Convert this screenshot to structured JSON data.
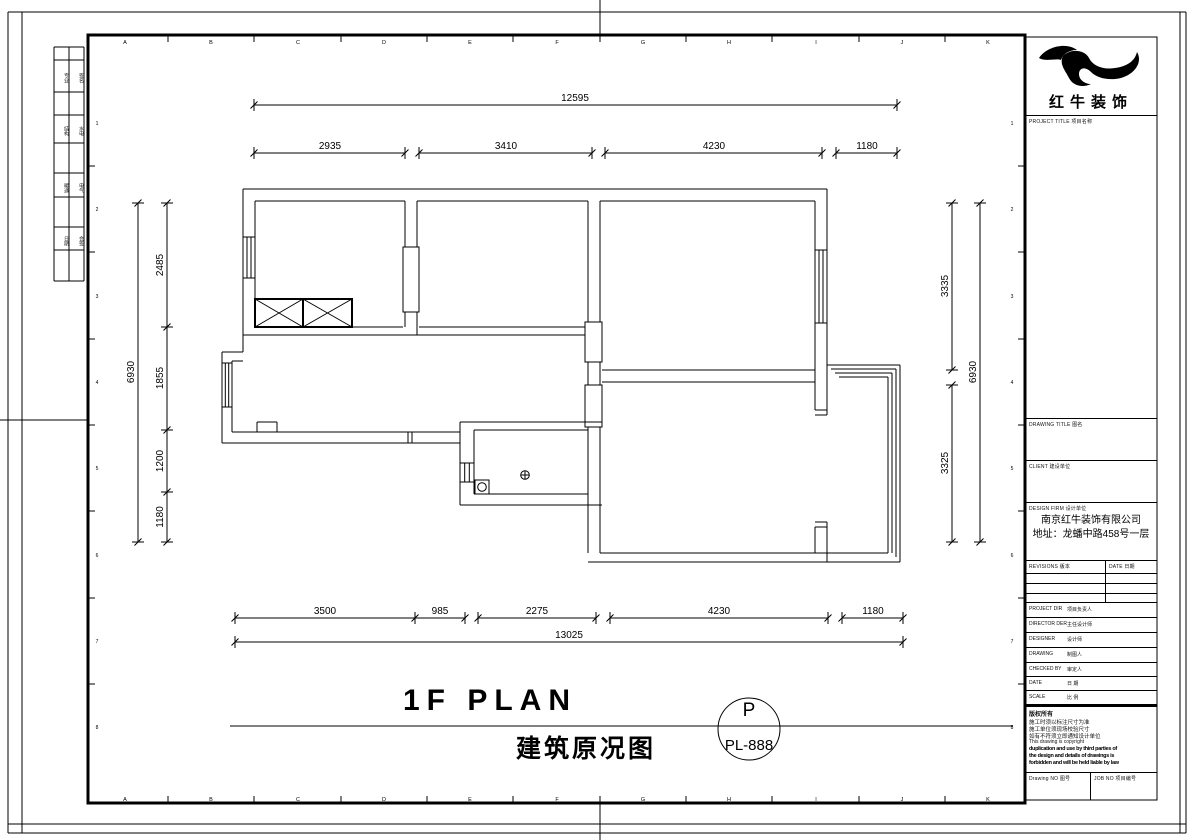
{
  "sheet": {
    "ruler_letters": [
      "A",
      "B",
      "C",
      "D",
      "E",
      "F",
      "G",
      "H",
      "I",
      "J",
      "K"
    ],
    "ruler_numbers": [
      "1",
      "2",
      "3",
      "4",
      "5",
      "6",
      "7",
      "8"
    ],
    "margin_cells": [
      "专业",
      "签名",
      "结构",
      "水电",
      "暖通",
      "电气",
      "日期",
      "会签"
    ]
  },
  "plan": {
    "dim_top_overall": "12595",
    "dim_top": [
      "2935",
      "3410",
      "4230",
      "1180"
    ],
    "dim_left_overall": "6930",
    "dim_left": [
      "2485",
      "1855",
      "1200",
      "1180"
    ],
    "dim_right_overall": "6930",
    "dim_right": [
      "3335",
      "3325"
    ],
    "dim_bottom": [
      "3500",
      "985",
      "2275",
      "4230",
      "1180"
    ],
    "dim_bottom_overall": "13025"
  },
  "title": {
    "main": "1F PLAN",
    "subtitle": "建筑原况图",
    "badge_letter": "P",
    "badge_code": "PL-888"
  },
  "titleblock": {
    "brand": "红牛装饰",
    "labels": {
      "project_title": "PROJECT TITLE  项目名称",
      "drawing_title": "DRAWING TITLE  图名",
      "client": "CLIENT  建设单位",
      "design_firm": "DESIGN FIRM  设计单位",
      "revisions": "REVISIONS  版本",
      "date": "DATE  日期",
      "drawing_no": "Drawing NO  图号",
      "job_no": "JOB NO  项目编号"
    },
    "firm_name": "南京红牛装饰有限公司",
    "firm_address": "地址：龙蟠中路458号一层",
    "rows": [
      {
        "en": "PROJECT DIR",
        "cn": "项目负责人"
      },
      {
        "en": "DIRECTOR DER",
        "cn": "主任设计师"
      },
      {
        "en": "DESIGNER",
        "cn": "设计师"
      },
      {
        "en": "DRAWING",
        "cn": "制图人"
      },
      {
        "en": "CHECKED BY",
        "cn": "审定人"
      },
      {
        "en": "DATE",
        "cn": "日  期"
      },
      {
        "en": "SCALE",
        "cn": "比  例"
      }
    ],
    "copyright": {
      "title": "版权所有",
      "note1": "施工时须以标注尺寸为准",
      "note2": "施工单位须现场校验尺寸",
      "note3": "如有不符须立即通知设计单位",
      "note4": "This drawing is copyright",
      "fine1": "duplication and use by third parties of",
      "fine2": "the design and details of drawings is",
      "fine3": "forbidden and will be held liable by law"
    }
  }
}
